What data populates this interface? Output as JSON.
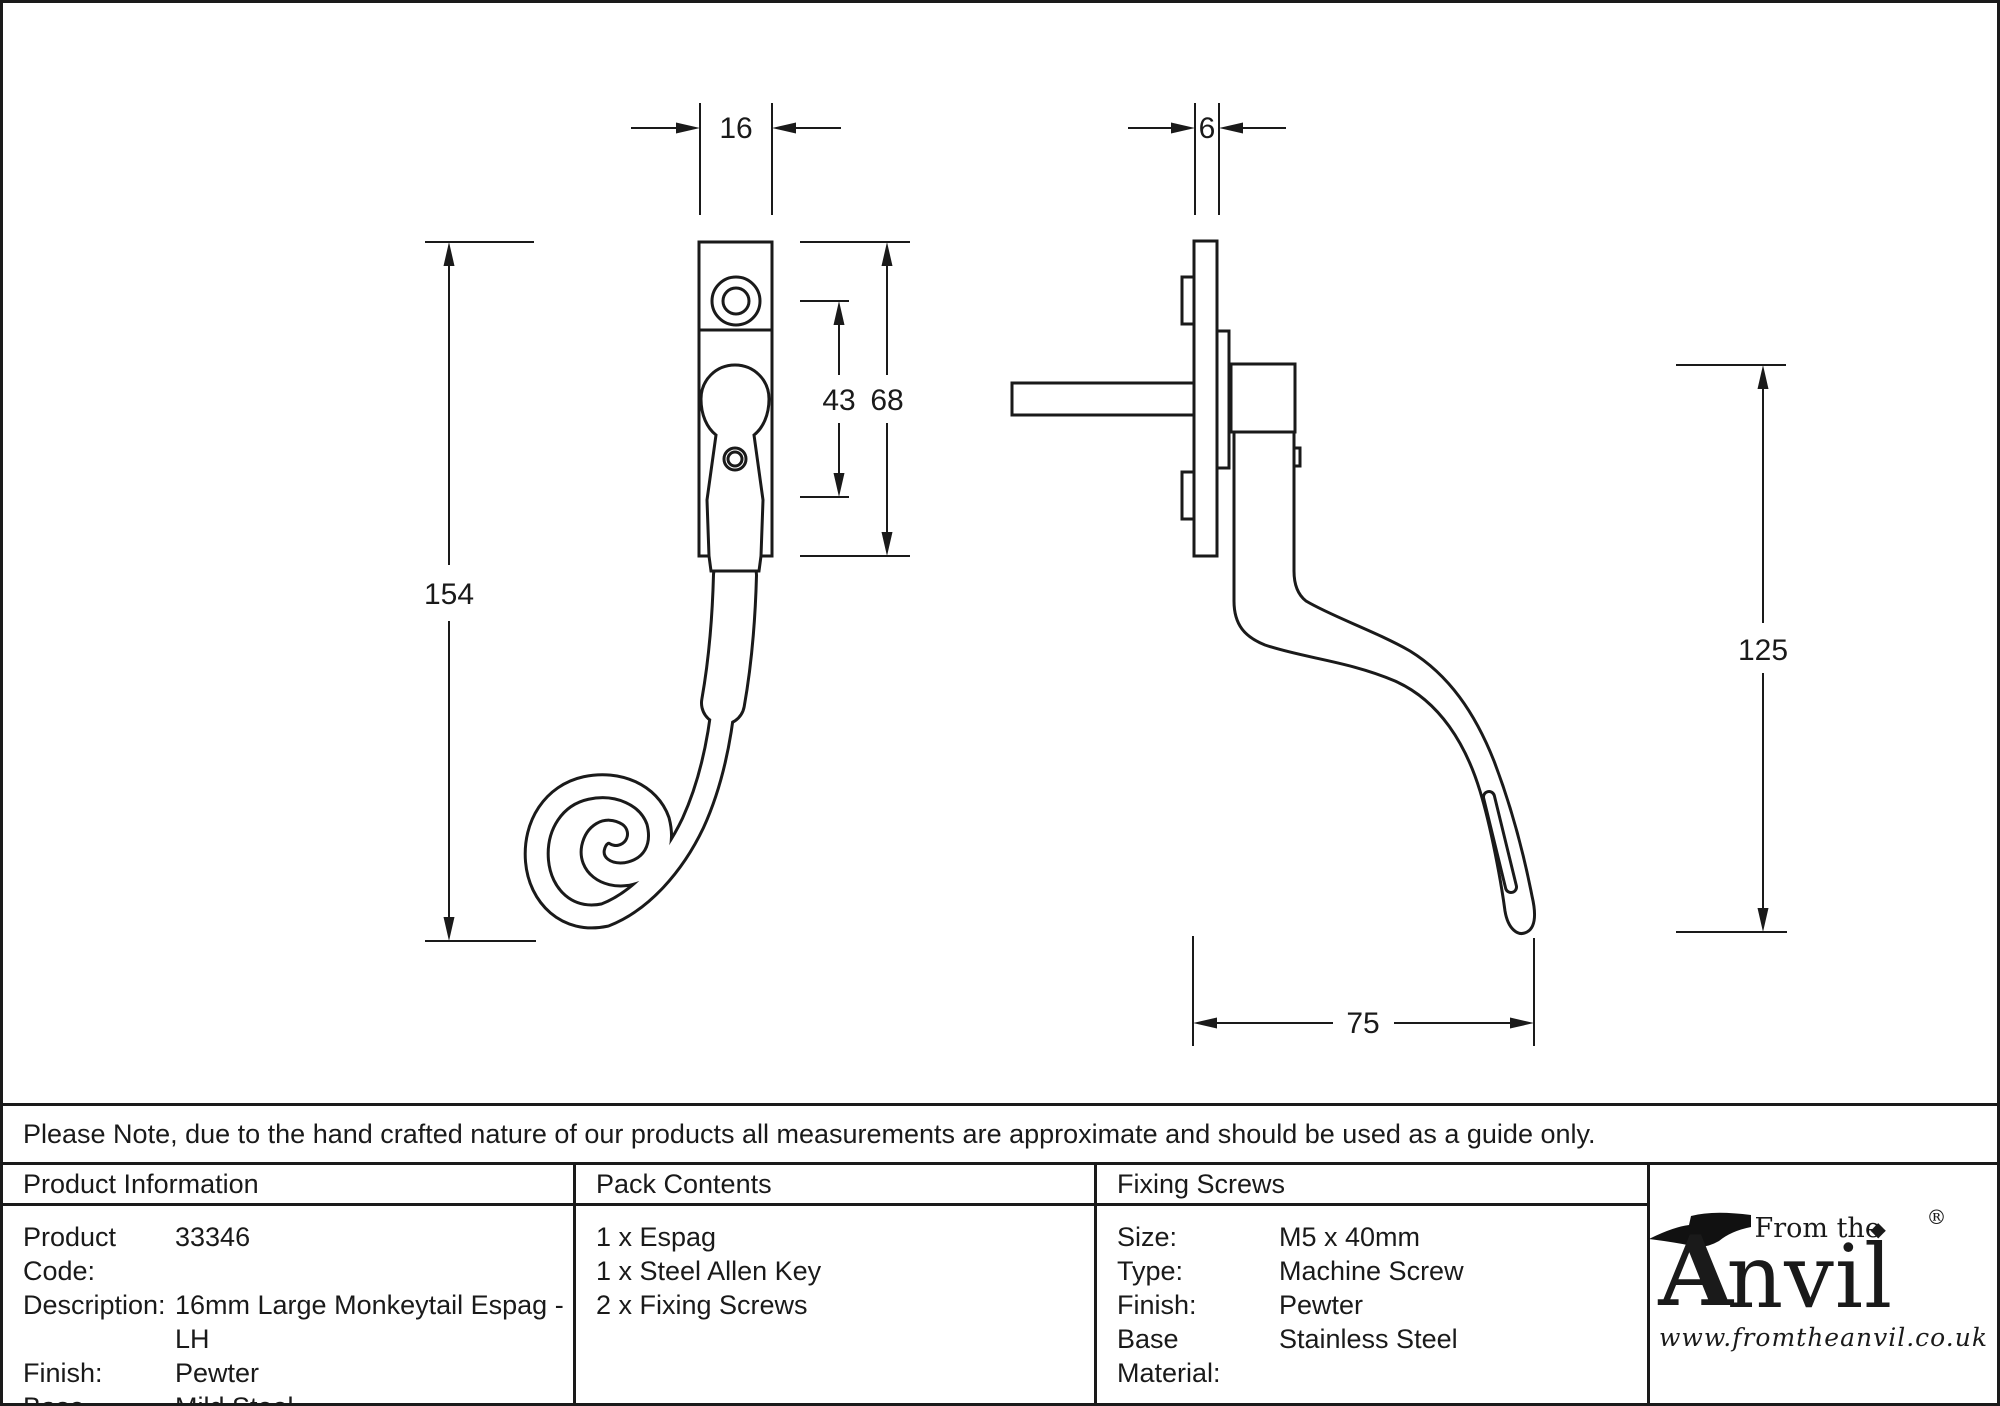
{
  "drawing": {
    "front_view": {
      "dim_width": "16",
      "dim_screw_centre": "43",
      "dim_plate_height": "68",
      "dim_overall_length": "154"
    },
    "side_view": {
      "dim_plate_thickness": "6",
      "dim_drop_height": "125",
      "dim_projection": "75"
    }
  },
  "note": {
    "text": "Please Note, due to the hand crafted nature of our products all measurements are approximate and should be used as a guide only."
  },
  "table": {
    "product_information": {
      "header": "Product Information",
      "rows": [
        {
          "label": "Product Code:",
          "value": "33346"
        },
        {
          "label": "Description:",
          "value": "16mm Large Monkeytail Espag - LH"
        },
        {
          "label": "Finish:",
          "value": "Pewter"
        },
        {
          "label": "Base Material:",
          "value": "Mild Steel"
        }
      ]
    },
    "pack_contents": {
      "header": "Pack Contents",
      "items": [
        "1 x Espag",
        "1 x Steel Allen Key",
        "2 x Fixing Screws"
      ]
    },
    "fixing_screws": {
      "header": "Fixing Screws",
      "rows": [
        {
          "label": "Size:",
          "value": "M5 x 40mm"
        },
        {
          "label": "Type:",
          "value": "Machine Screw"
        },
        {
          "label": "Finish:",
          "value": "Pewter"
        },
        {
          "label": "Base Material:",
          "value": "Stainless Steel"
        }
      ]
    }
  },
  "logo": {
    "initial": "A",
    "prefix": "From the",
    "suffix": "nvil",
    "diamond": "◆",
    "registered": "®",
    "website": "www.fromtheanvil.co.uk"
  }
}
